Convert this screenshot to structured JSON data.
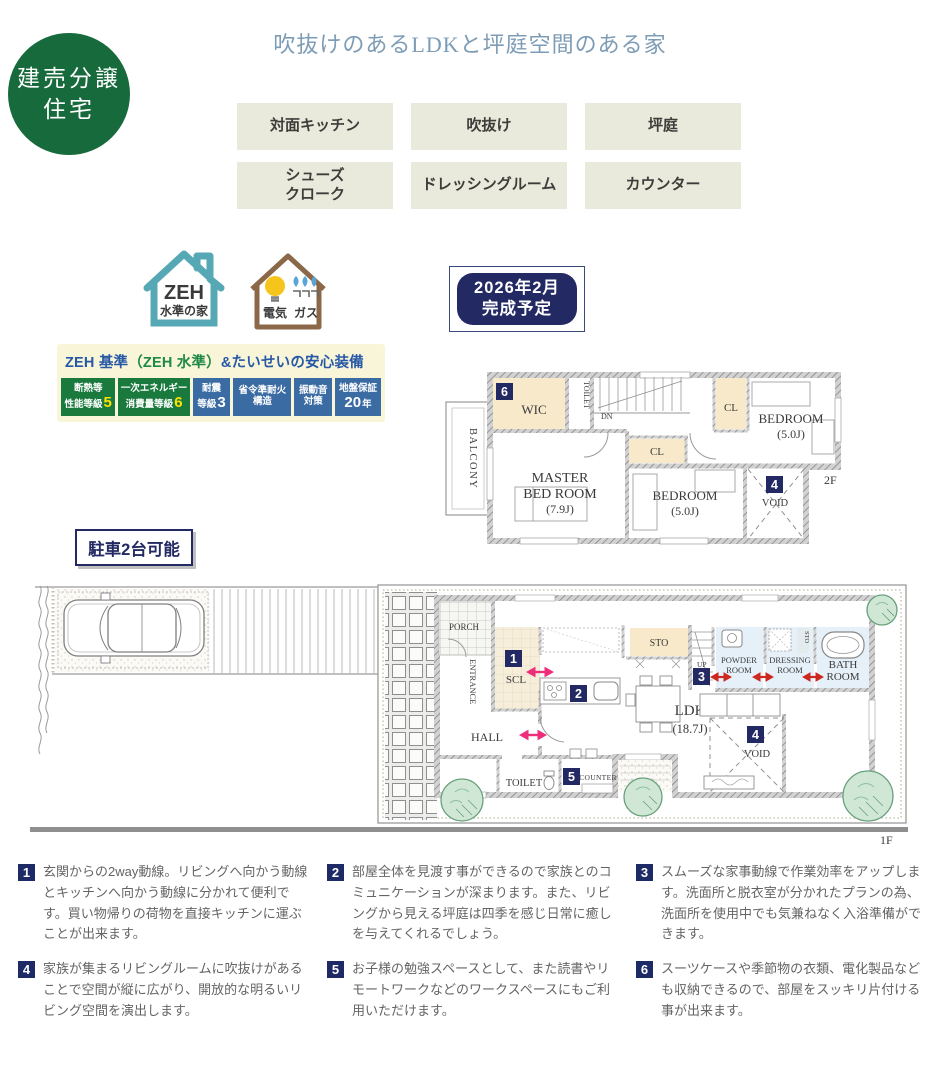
{
  "corner_badge": {
    "line1": "建売分譲",
    "line2": "住宅"
  },
  "title": "吹抜けのあるLDKと坪庭空間のある家",
  "features": [
    "対面キッチン",
    "吹抜け",
    "坪庭",
    "シューズ\nクローク",
    "ドレッシングルーム",
    "カウンター"
  ],
  "zeh_icon": {
    "line1": "ZEH",
    "line2": "水準の家"
  },
  "energy_icon": {
    "electric": "電気",
    "gas": "ガス"
  },
  "warranty": {
    "title_part1": "ZEH 基準",
    "title_part2": "（ZEH 水準）",
    "title_part3": "&たいせいの安心装備",
    "badges": [
      {
        "line1": "断熱等",
        "line2": "性能等級",
        "big": "5",
        "suffix": ""
      },
      {
        "line1": "一次エネルギー",
        "line2": "消費量等級",
        "big": "6",
        "suffix": ""
      },
      {
        "line1": "耐震",
        "line2": "等級",
        "big": "3",
        "suffix": ""
      },
      {
        "line1": "省令準耐火",
        "line2": "構造",
        "big": "",
        "suffix": ""
      },
      {
        "line1": "振動音",
        "line2": "対策",
        "big": "",
        "suffix": ""
      },
      {
        "line1": "地盤保証",
        "line2": "",
        "big": "20",
        "suffix": "年"
      }
    ]
  },
  "completion": {
    "line1": "2026年2月",
    "line2": "完成予定"
  },
  "parking_label": "駐車2台可能",
  "f2": {
    "label": "2F",
    "balcony": "BALCONY",
    "wic": "WIC",
    "badge6": "6",
    "toilet": "TOILET",
    "dn": "DN",
    "master1": "MASTER",
    "master2": "BED ROOM",
    "master_size": "(7.9J)",
    "cl1": "CL",
    "cl2": "CL",
    "bed1": "BEDROOM",
    "bed1_size": "(5.0J)",
    "bed2": "BEDROOM",
    "bed2_size": "(5.0J)",
    "badge4": "4",
    "void": "VOID"
  },
  "f1": {
    "label": "1F",
    "porch": "PORCH",
    "entrance": "ENTRANCE",
    "badge1": "1",
    "scl": "SCL",
    "badge2": "2",
    "sto1": "STO",
    "up": "UP",
    "badge3": "3",
    "powder1": "POWDER",
    "powder2": "ROOM",
    "dressing1": "DRESSING",
    "dressing2": "ROOM",
    "sto2": "STO",
    "bath1": "BATH",
    "bath2": "ROOM",
    "hall": "HALL",
    "toilet": "TOILET",
    "badge5": "5",
    "counter": "COUNTER",
    "ldk": "LDK",
    "ldk_size": "(18.7J)",
    "badge4": "4",
    "void": "VOID"
  },
  "notes": [
    {
      "num": "1",
      "text": "玄関からの2way動線。リビングへ向かう動線とキッチンへ向かう動線に分かれて便利です。買い物帰りの荷物を直接キッチンに運ぶことが出来ます。"
    },
    {
      "num": "2",
      "text": "部屋全体を見渡す事ができるので家族とのコミュニケーションが深まります。また、リビングから見える坪庭は四季を感じ日常に癒しを与えてくれるでしょう。"
    },
    {
      "num": "3",
      "text": "スムーズな家事動線で作業効率をアップします。洗面所と脱衣室が分かれたプランの為、洗面所を使用中でも気兼ねなく入浴準備ができます。"
    },
    {
      "num": "4",
      "text": "家族が集まるリビングルームに吹抜けがあることで空間が縦に広がり、開放的な明るいリビング空間を演出します。"
    },
    {
      "num": "5",
      "text": "お子様の勉強スペースとして、また読書やリモートワークなどのワークスペースにもご利用いただけます。"
    },
    {
      "num": "6",
      "text": "スーツケースや季節物の衣類、電化製品なども収納できるので、部屋をスッキリ片付ける事が出来ます。"
    }
  ],
  "colors": {
    "brand_green": "#176a3c",
    "title_blue": "#7d9cb5",
    "navy": "#232a63",
    "badge_green": "#1a7a3e",
    "badge_blue": "#3a6ca3",
    "tag_beige": "#eaeadc",
    "room_beige": "#f7e9c9",
    "wet_room_blue": "#dcebf7",
    "accent_pink": "#ee2d7b",
    "accent_red": "#cc2820"
  }
}
